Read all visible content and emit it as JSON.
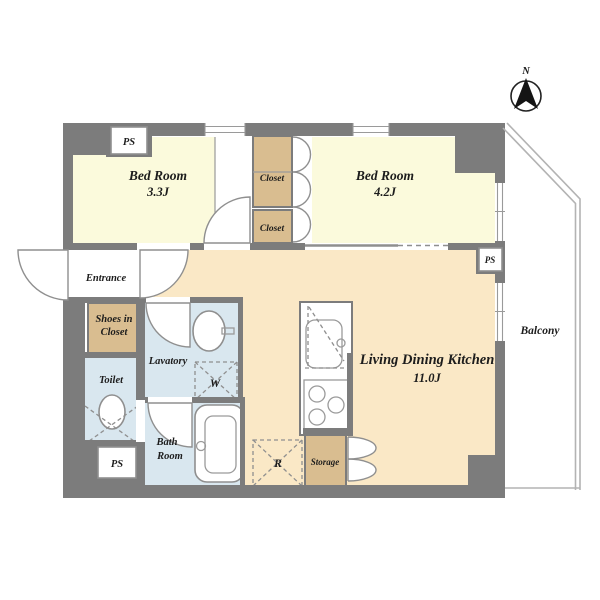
{
  "plan": {
    "title": "apartment-floor-plan",
    "compass": {
      "label": "N"
    },
    "rooms": {
      "bedroom1": {
        "name": "Bed Room",
        "size": "3.3J"
      },
      "bedroom2": {
        "name": "Bed Room",
        "size": "4.2J"
      },
      "ldk": {
        "name": "Living Dining Kitchen",
        "size": "11.0J"
      },
      "entrance": {
        "name": "Entrance"
      },
      "shoes_closet": {
        "line1": "Shoes in",
        "line2": "Closet"
      },
      "toilet": {
        "name": "Toilet"
      },
      "lavatory": {
        "name": "Lavatory"
      },
      "bathroom": {
        "line1": "Bath",
        "line2": "Room"
      },
      "closet_upper": {
        "name": "Closet"
      },
      "closet_lower": {
        "name": "Closet"
      },
      "storage": {
        "name": "Storage"
      },
      "balcony": {
        "name": "Balcony"
      }
    },
    "markers": {
      "ps_top": "PS",
      "ps_right": "PS",
      "ps_bottom": "PS",
      "washer": "W",
      "refrigerator": "R"
    },
    "colors": {
      "wall": "#7c7c7c",
      "bedroom_floor": "#fbfadc",
      "ldk_floor": "#fae8c6",
      "closet": "#d9bd90",
      "wet_area": "#d9e7ef",
      "white": "#ffffff",
      "text": "#1c1c1c"
    }
  }
}
